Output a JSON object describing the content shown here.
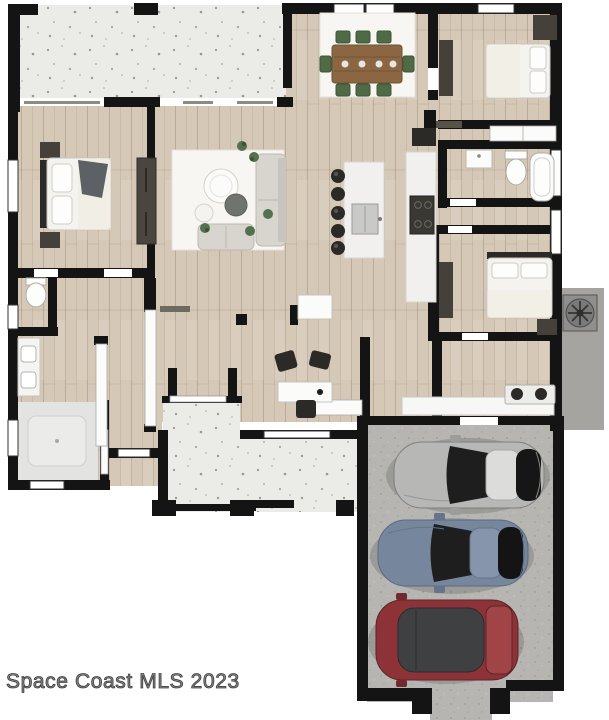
{
  "watermark": {
    "text": "Space Coast MLS 2023"
  },
  "palette": {
    "bg": "#ffffff",
    "wall": "#141414",
    "wood": "#d5c8b6",
    "wood-line": "#b9aa95",
    "concrete-light": "#ebebe8",
    "concrete-drive": "#b6b5b2",
    "ac-pad": "#a5a4a1",
    "rug": "#f7f6f3",
    "marble": "#f1f0ee",
    "sofa": "#d8d5cf",
    "furn-dark": "#45413a",
    "furn-black": "#2c2a27",
    "plant-green": "#55704e",
    "chair-green": "#4e6b45",
    "table-wood": "#8a6742",
    "linen": "#f4f3f0",
    "throw-gray": "#5d6065",
    "car-silver": "#b7b7b5",
    "car-blue": "#76869d",
    "car-red": "#8d3337",
    "glass-dark": "#1e1e1e",
    "watermark-fill": "#8a8a8a",
    "watermark-stroke": "#3f3f3f"
  },
  "floor_plan": {
    "type": "single-family-home-top-view",
    "areas": [
      "front-porch",
      "master-bedroom",
      "master-bathroom",
      "walk-in-shower",
      "toilet-room",
      "living-room",
      "dining-area",
      "kitchen",
      "hallway",
      "bedroom-2",
      "bathroom-2",
      "bedroom-3",
      "laundry-room",
      "covered-patio",
      "garage-driveway",
      "ac-equipment-pad"
    ],
    "furniture": [
      "master-bed",
      "nightstands",
      "barn-door",
      "sofa",
      "loveseat",
      "coffee-table",
      "ottoman",
      "area-rug",
      "potted-plants",
      "dining-table",
      "dining-chairs",
      "wardrobe",
      "dresser",
      "bed-2",
      "bed-3",
      "kitchen-island",
      "bar-stools",
      "island-sink",
      "range-cooktop",
      "refrigerator",
      "vanity-sink",
      "toilet",
      "bathtub",
      "washer-dryer",
      "laundry-counter",
      "game-table",
      "game-chairs",
      "air-conditioner-unit"
    ],
    "vehicles": [
      {
        "name": "silver-sports-car"
      },
      {
        "name": "blue-sedan"
      },
      {
        "name": "red-hatchback"
      }
    ]
  }
}
